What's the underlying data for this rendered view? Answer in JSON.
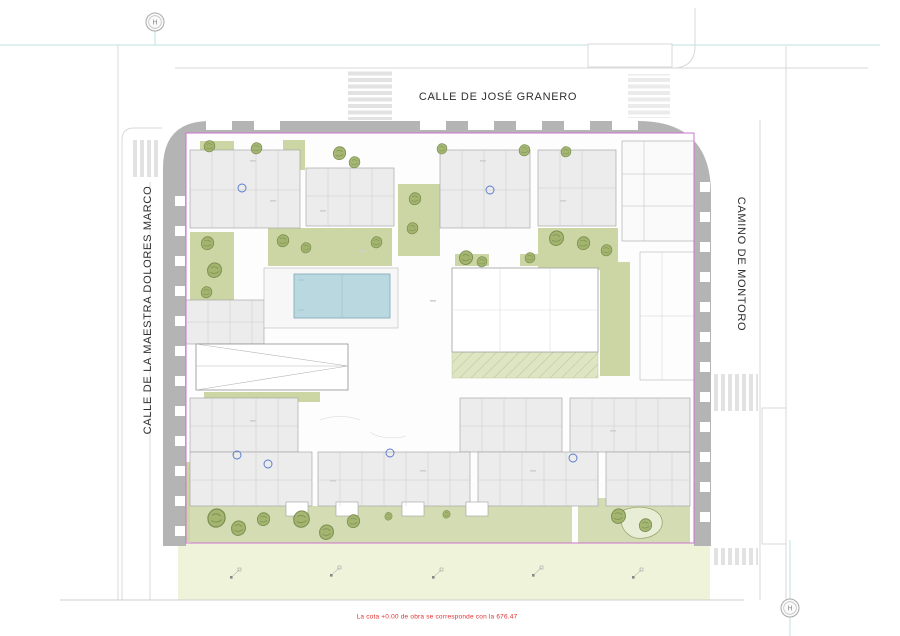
{
  "streets": {
    "top": "CALLE DE JOSÉ GRANERO",
    "left": "CALLE DE LA MAESTRA DOLORES MARCO",
    "right": "CAMINO DE MONTORO"
  },
  "note": {
    "elevation": "La cota +0.00 de obra se corresponde con la 676.47"
  },
  "markers": {
    "hydrant_top": "H",
    "hydrant_bottom": "H"
  },
  "colors": {
    "building_band": "#b4b4b4",
    "property_line": "#cc74cc",
    "pool_water": "#b9d8e0",
    "garden_green": "#ccd6a4",
    "lawn_green": "#eef3da",
    "tree_green": "#9fb269",
    "note_red": "#e03030",
    "survey_cyan": "#bfe2e2"
  }
}
